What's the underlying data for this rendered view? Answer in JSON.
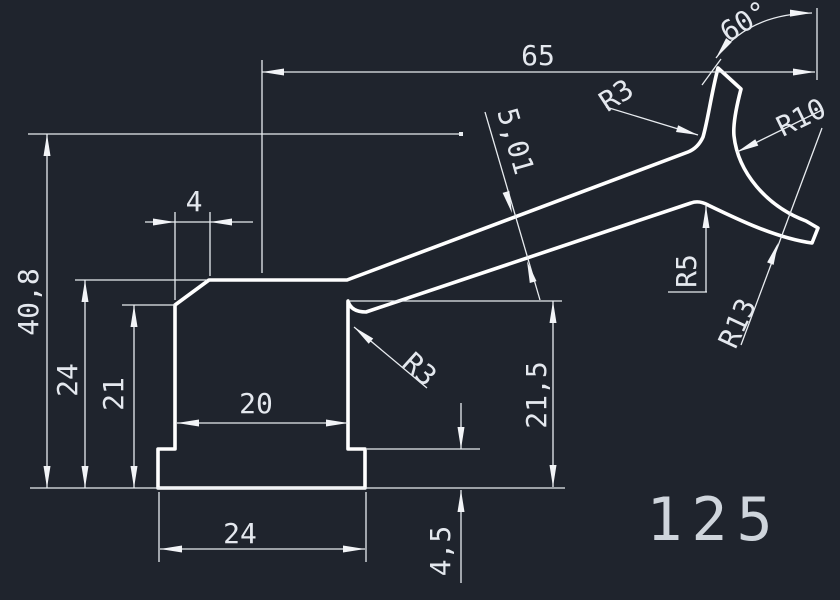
{
  "canvas": {
    "background_color": "#1f242d",
    "profile_line_color": "#ffffff",
    "dimension_line_color": "#e8ecf0",
    "drawing_number_color": "#cfd5dc"
  },
  "drawing_number": "125",
  "dimensions": {
    "overall_width_top": "65",
    "prong_angle": "60°",
    "fillet_fork": "R3",
    "radius_inner_hook": "R10",
    "arm_thickness": "5,01",
    "chamfer_width": "4",
    "height_total": "40,8",
    "height_body": "24",
    "height_chamfer_start": "21",
    "fillet_arm_corner": "R3",
    "height_right_wall": "21,5",
    "radius_bump": "R5",
    "radius_outer_hook": "R13",
    "slot_width": "20",
    "base_width": "24",
    "base_step_height": "4,5"
  }
}
